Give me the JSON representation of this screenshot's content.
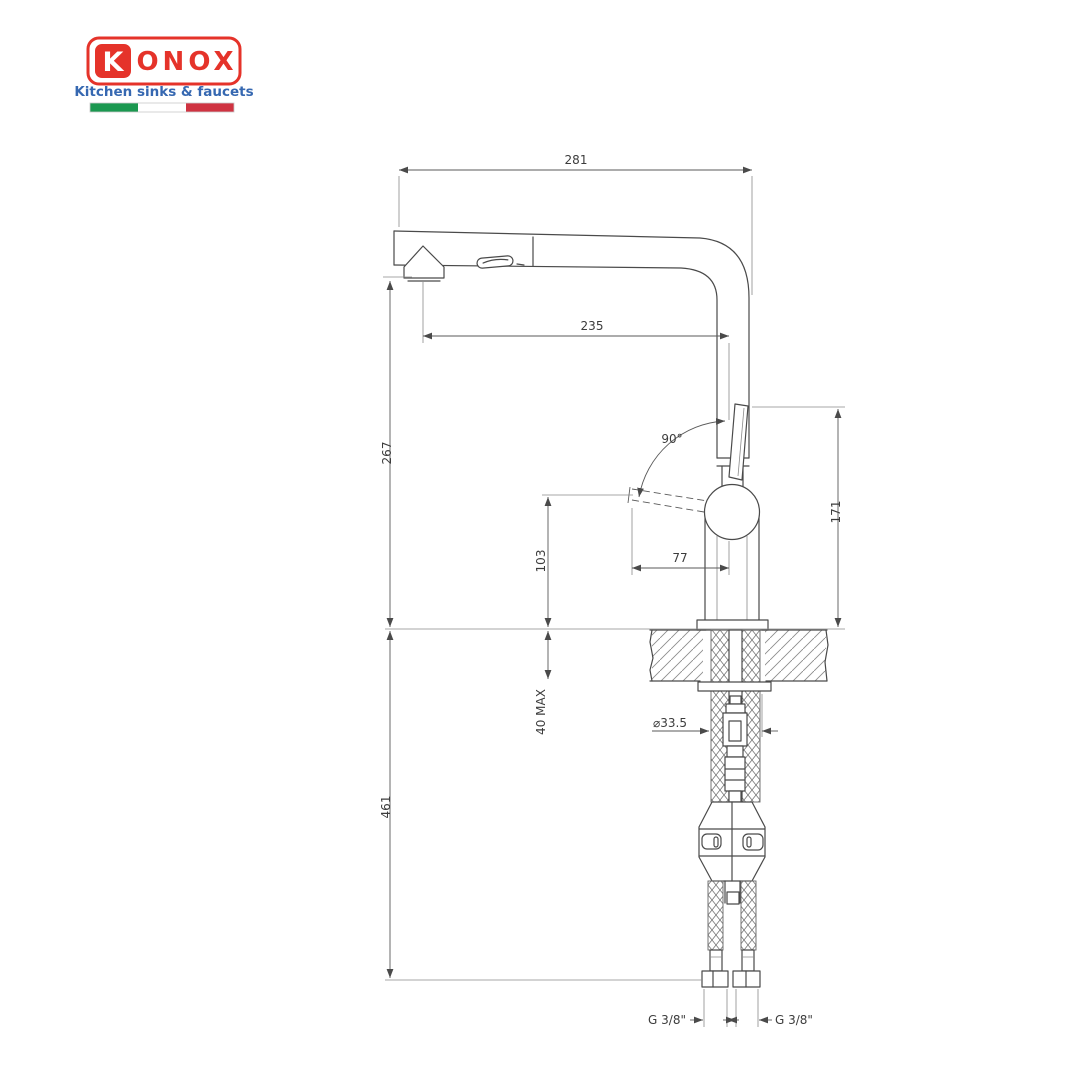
{
  "logo": {
    "brand": "KONOX",
    "brand_initial": "K",
    "brand_rest": "ONOX",
    "tagline": "Kitchen sinks & faucets",
    "colors": {
      "red": "#e5332a",
      "blue": "#3668b1",
      "flag_green": "#1b9850",
      "flag_white": "#ffffff",
      "flag_red": "#cf3341"
    }
  },
  "drawing": {
    "line_color": "#4a4a4a",
    "dimensions": {
      "spout_width": "281",
      "spout_reach": "235",
      "spout_height": "267",
      "handle_to_counter": "103",
      "handle_reach": "77",
      "handle_angle": "90°",
      "body_top_height": "171",
      "counter_thickness_max": "40 MAX",
      "hole_diameter": "⌀33.5",
      "hose_drop": "461",
      "thread_left": "G 3/8\"",
      "thread_right": "G 3/8\""
    }
  }
}
